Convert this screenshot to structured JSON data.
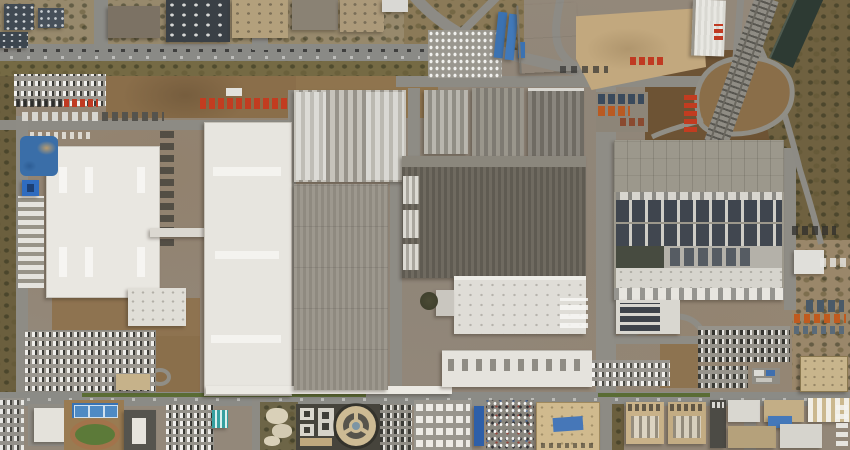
{
  "scene": {
    "type": "satellite-aerial-photograph",
    "subject": "Large automotive factory campus seen from above: white and gray assembly halls, a solar-panel roof, truck and container yards, employee parking lots, a vehicle test track loop, a railway line with canal, an urban district to the north and sports facilities to the south",
    "season_look": "dry winter, brown vegetation, low sun with shadows cast to the lower-left",
    "width_px": 850,
    "height_px": 450
  },
  "palette": {
    "ground_base": "#93887a",
    "dirt": "#8a6e4a",
    "dirt_dark": "#6d5334",
    "asphalt": "#8b8b86",
    "lot_gray": "#9c9890",
    "roof_white": "#e9e7e1",
    "roof_gray": "#9b968c",
    "roof_dark": "#6f6a60",
    "roof_striped_light": "#c6c3bb",
    "solar_panel": "#3f454e",
    "tan_yard": "#c2a87e",
    "tan_building": "#c9b289",
    "blue_roof": "#3b72b2",
    "blue_court": "#3873b4",
    "pond_blue": "#3a6ea8",
    "cyan_roof": "#35a0a0",
    "green_field": "#5c7a39",
    "running_track": "#a2734b",
    "median_green": "#5a6c34",
    "trees": "#6b5f3e",
    "railway": "#8f8c84",
    "canal_water": "#2d3a33",
    "red_truck": "#c03a22",
    "orange_truck": "#c05a1e",
    "urban_roof": "#414a53",
    "round_pavilion": "#cdbb94"
  },
  "features": {
    "scene": {
      "label": "Satellite view of automotive factory campus"
    },
    "urban_district": {
      "label": "Urban district with apartment blocks"
    },
    "boulevard": {
      "label": "Tree-lined boulevard with traffic"
    },
    "median_trees": {
      "label": "Road median tree row"
    },
    "dirt_field_nw": {
      "label": "Bare dirt field"
    },
    "parking_nw": {
      "label": "Employee parking lot"
    },
    "red_trucks": {
      "label": "Row of red trucks"
    },
    "truck_rows": {
      "label": "Parked truck trailers"
    },
    "white_car_lot": {
      "label": "Finished vehicle lot with white cars"
    },
    "blue_sheds": {
      "label": "Blue-roofed long sheds"
    },
    "warehouse_nw": {
      "label": "White striped warehouse"
    },
    "tan_yard": {
      "label": "Large tan paved storage yard"
    },
    "warehouse_ne": {
      "label": "White logistics warehouse with docks"
    },
    "container_yard": {
      "label": "Container and truck yard"
    },
    "test_track": {
      "label": "Vehicle test track loop"
    },
    "railway": {
      "label": "Railway line"
    },
    "canal": {
      "label": "Canal in riparian brush"
    },
    "brush": {
      "label": "Dry brush and trees along railway"
    },
    "hall_a": {
      "label": "White factory hall A with roof-vent grid"
    },
    "hall_b": {
      "label": "White factory hall B with roof-vent grid"
    },
    "hall_c": {
      "label": "Striped light-gray hall (paint shop)"
    },
    "hall_d": {
      "label": "Gray corrugated hall"
    },
    "hall_e": {
      "label": "Large dark-gray press hall"
    },
    "hall_f": {
      "label": "White annex hall"
    },
    "hall_g": {
      "label": "Long white hall with roof vents"
    },
    "solar_building": {
      "label": "Assembly hall with rooftop solar arrays"
    },
    "bridge": {
      "label": "Elevated conveyor bridge between halls"
    },
    "canopy": {
      "label": "Long white south canopy"
    },
    "pond": {
      "label": "Blue pond / tarp area"
    },
    "blue_utility": {
      "label": "Small blue-roofed utility building"
    },
    "south_road": {
      "label": "Main east-west campus road"
    },
    "sports_field": {
      "label": "Running track and soccer field"
    },
    "courts": {
      "label": "Blue tennis / basketball courts"
    },
    "office_block": {
      "label": "Office building"
    },
    "round_pavilion": {
      "label": "Circular pavilion with three spokes"
    },
    "park": {
      "label": "Landscaped park with paths"
    },
    "south_parking": {
      "label": "Dense visitor parking"
    },
    "white_truck_lot": {
      "label": "White truck and van lot"
    },
    "colorful_parking": {
      "label": "Crowded multicolored car park"
    },
    "tan_blocks_south": {
      "label": "Tan commercial buildings"
    },
    "east_service": {
      "label": "Eastern service yards and trucks"
    }
  }
}
